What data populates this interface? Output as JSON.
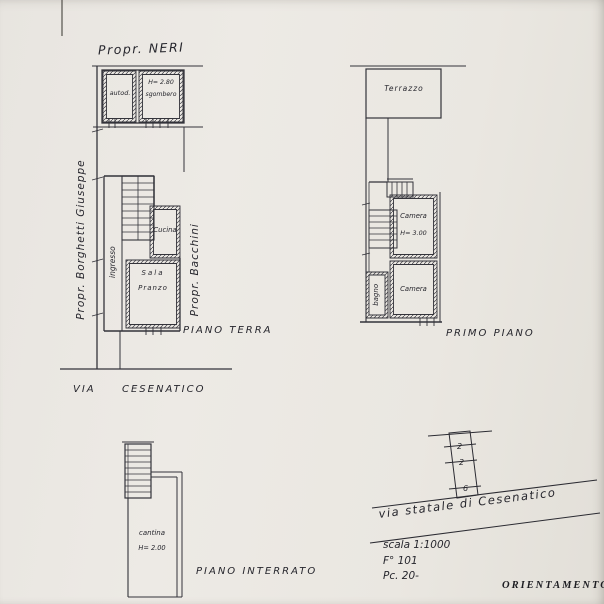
{
  "colors": {
    "paper": "#eae7e2",
    "ink": "#33333a",
    "handwriting": "#26262d"
  },
  "plans": {
    "ground_floor": {
      "owner_top": "Propr. NERI",
      "owner_left": "Propr. Borghetti Giuseppe",
      "owner_right": "Propr. Bacchini",
      "annex_room": "autod.",
      "annex_height": "H= 2.80",
      "annex_use": "sgombero",
      "hall": "ingresso",
      "kitchen": "Cucina",
      "dining_line1": "Sala",
      "dining_line2": "Pranzo",
      "caption": "PIANO TERRA",
      "street_word1": "VIA",
      "street_word2": "CESENATICO"
    },
    "first_floor": {
      "terrace": "Terrazzo",
      "bedroom1": "Camera",
      "bedroom1_height": "H= 3.00",
      "bedroom2": "Camera",
      "bathroom": "bagno",
      "caption": "PRIMO PIANO"
    },
    "basement": {
      "cellar": "cantina",
      "cellar_height": "H= 2.00",
      "caption": "PIANO INTERRATO"
    }
  },
  "orientation": {
    "caption": "ORIENTAMENTO",
    "road_label": "via statale di Cesenatico",
    "scale": "scala 1:1000",
    "sheet": "F° 101",
    "parcel": "Pc. 20-",
    "strip_marks": [
      "2",
      "2",
      "6"
    ]
  }
}
